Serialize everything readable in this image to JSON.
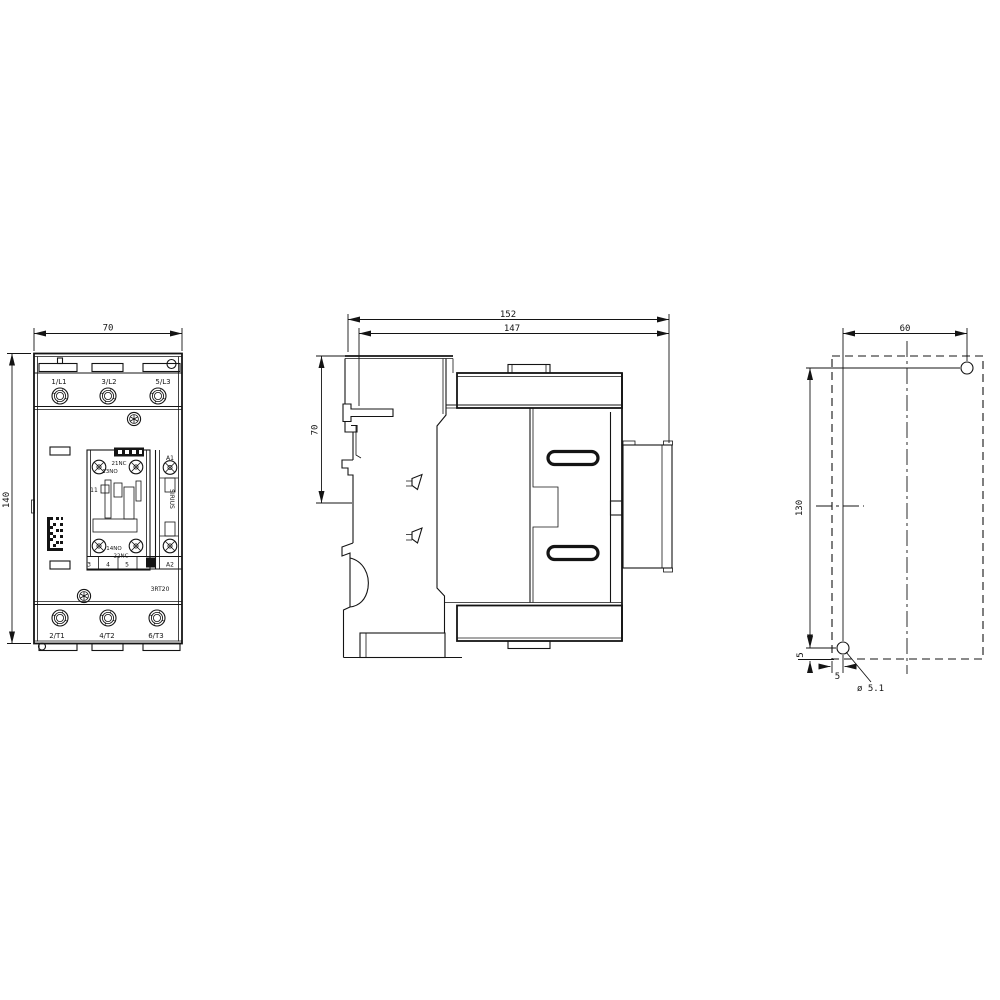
{
  "drawing": {
    "front_view": {
      "dim_width": "70",
      "dim_height": "140",
      "top_terminals": [
        "1/L1",
        "3/L2",
        "5/L3"
      ],
      "bottom_terminals": [
        "2/T1",
        "4/T2",
        "6/T3"
      ],
      "aux_block": {
        "label_top_nc": "21NC",
        "label_top_no": "13NO",
        "label_pole": "11",
        "label_bottom_no": "14NO",
        "label_bottom_nc": "22NC",
        "terminal_row": [
          "3",
          "4",
          "5"
        ],
        "terminal_row_coil": "A2"
      },
      "coil_terminal_top": "A1",
      "brand_label": "SIRIUS",
      "product_label": "3RT20"
    },
    "side_view": {
      "dim_total_depth": "152",
      "dim_mount_depth": "147",
      "dim_rail_height": "70"
    },
    "mounting_view": {
      "dim_hole_spacing_x": "60",
      "dim_hole_spacing_y": "130",
      "dim_edge_offset_x": "5",
      "dim_edge_offset_y": "5",
      "hole_diameter": "ø 5.1"
    }
  }
}
